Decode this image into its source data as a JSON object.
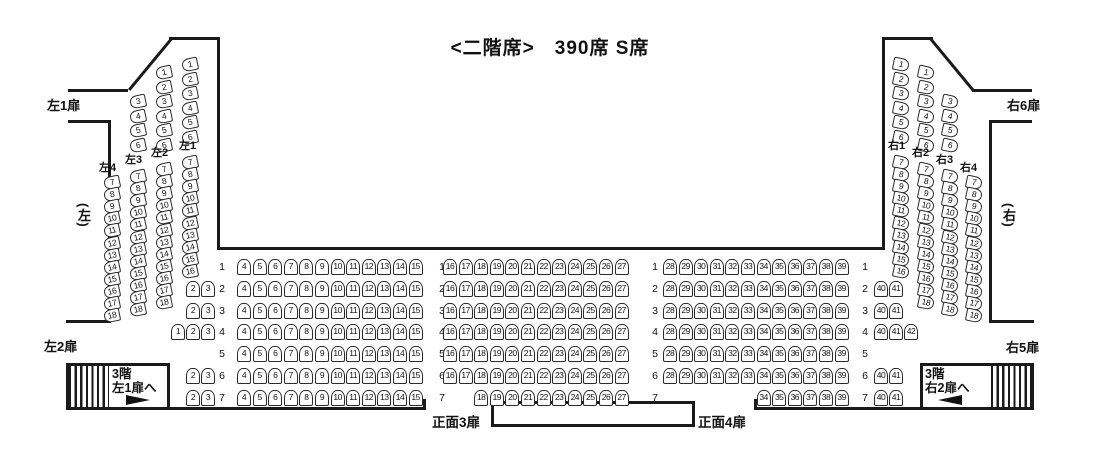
{
  "title": "<二階席>　390席 S席",
  "doors": {
    "left1": "左1扉",
    "left2": "左2扉",
    "right6": "右6扉",
    "right5": "右5扉",
    "front3": "正面3扉",
    "front4": "正面4扉"
  },
  "zones": {
    "left": "(左)",
    "right": "(右)"
  },
  "stairs": {
    "left": {
      "line1": "3階",
      "line2": "左1扉へ"
    },
    "right": {
      "line1": "3階",
      "line2": "右2扉へ"
    }
  },
  "colors": {
    "line": "#1a1a1a",
    "seat_border": "#2b2b2b",
    "background": "#ffffff"
  },
  "side_columns": {
    "left": [
      {
        "id": "L4",
        "label": "左4",
        "upper": [],
        "lower": [
          7,
          8,
          9,
          10,
          11,
          12,
          13,
          14,
          15,
          16,
          17,
          18
        ]
      },
      {
        "id": "L3",
        "label": "左3",
        "upper": [
          3,
          4,
          5,
          6
        ],
        "lower": [
          7,
          8,
          9,
          10,
          11,
          12,
          13,
          14,
          15,
          16,
          17,
          18
        ]
      },
      {
        "id": "L2",
        "label": "左2",
        "upper": [
          1,
          2,
          3,
          4,
          5,
          6
        ],
        "lower": [
          7,
          8,
          9,
          10,
          11,
          12,
          13,
          14,
          15,
          16,
          17,
          18
        ]
      },
      {
        "id": "L1",
        "label": "左1",
        "upper": [
          1,
          2,
          3,
          4,
          5,
          6
        ],
        "lower": [
          7,
          8,
          9,
          10,
          11,
          12,
          13,
          14,
          15,
          16
        ]
      }
    ],
    "right": [
      {
        "id": "R1",
        "label": "右1",
        "upper": [
          1,
          2,
          3,
          4,
          5,
          6
        ],
        "lower": [
          7,
          8,
          9,
          10,
          11,
          12,
          13,
          14,
          15,
          16
        ]
      },
      {
        "id": "R2",
        "label": "右2",
        "upper": [
          1,
          2,
          3,
          4,
          5,
          6
        ],
        "lower": [
          7,
          8,
          9,
          10,
          11,
          12,
          13,
          14,
          15,
          16,
          17,
          18
        ]
      },
      {
        "id": "R3",
        "label": "右3",
        "upper": [
          3,
          4,
          5,
          6
        ],
        "lower": [
          7,
          8,
          9,
          10,
          11,
          12,
          13,
          14,
          15,
          16,
          17,
          18
        ]
      },
      {
        "id": "R4",
        "label": "右4",
        "upper": [],
        "lower": [
          7,
          8,
          9,
          10,
          11,
          12,
          13,
          14,
          15,
          16,
          17,
          18
        ]
      }
    ]
  },
  "rows": [
    {
      "num": 1,
      "left_extra": [],
      "left": [
        4,
        5,
        6,
        7,
        8,
        9,
        10,
        11,
        12,
        13,
        14,
        15
      ],
      "center": [
        16,
        17,
        18,
        19,
        20,
        21,
        22,
        23,
        24,
        25,
        26,
        27
      ],
      "right": [
        28,
        29,
        30,
        31,
        32,
        33,
        34,
        35,
        36,
        37,
        38,
        39
      ],
      "right_extra": []
    },
    {
      "num": 2,
      "left_extra": [
        2,
        3
      ],
      "left": [
        4,
        5,
        6,
        7,
        8,
        9,
        10,
        11,
        12,
        13,
        14,
        15
      ],
      "center": [
        16,
        17,
        18,
        19,
        20,
        21,
        22,
        23,
        24,
        25,
        26,
        27
      ],
      "right": [
        28,
        29,
        30,
        31,
        32,
        33,
        34,
        35,
        36,
        37,
        38,
        39
      ],
      "right_extra": [
        40,
        41
      ]
    },
    {
      "num": 3,
      "left_extra": [
        2,
        3
      ],
      "left": [
        4,
        5,
        6,
        7,
        8,
        9,
        10,
        11,
        12,
        13,
        14,
        15
      ],
      "center": [
        16,
        17,
        18,
        19,
        20,
        21,
        22,
        23,
        24,
        25,
        26,
        27
      ],
      "right": [
        28,
        29,
        30,
        31,
        32,
        33,
        34,
        35,
        36,
        37,
        38,
        39
      ],
      "right_extra": [
        40,
        41
      ]
    },
    {
      "num": 4,
      "left_extra": [
        1,
        2,
        3
      ],
      "left": [
        4,
        5,
        6,
        7,
        8,
        9,
        10,
        11,
        12,
        13,
        14,
        15
      ],
      "center": [
        16,
        17,
        18,
        19,
        20,
        21,
        22,
        23,
        24,
        25,
        26,
        27
      ],
      "right": [
        28,
        29,
        30,
        31,
        32,
        33,
        34,
        35,
        36,
        37,
        38,
        39
      ],
      "right_extra": [
        40,
        41,
        42
      ]
    },
    {
      "num": 5,
      "left_extra": [],
      "left": [
        4,
        5,
        6,
        7,
        8,
        9,
        10,
        11,
        12,
        13,
        14,
        15
      ],
      "center": [
        16,
        17,
        18,
        19,
        20,
        21,
        22,
        23,
        24,
        25,
        26,
        27
      ],
      "right": [
        28,
        29,
        30,
        31,
        32,
        33,
        34,
        35,
        36,
        37,
        38,
        39
      ],
      "right_extra": []
    },
    {
      "num": 6,
      "left_extra": [
        2,
        3
      ],
      "left": [
        4,
        5,
        6,
        7,
        8,
        9,
        10,
        11,
        12,
        13,
        14,
        15
      ],
      "center": [
        16,
        17,
        18,
        19,
        20,
        21,
        22,
        23,
        24,
        25,
        26,
        27
      ],
      "right": [
        28,
        29,
        30,
        31,
        32,
        33,
        34,
        35,
        36,
        37,
        38,
        39
      ],
      "right_extra": [
        40,
        41
      ]
    },
    {
      "num": 7,
      "left_extra": [
        2,
        3
      ],
      "left": [
        4,
        5,
        6,
        7,
        8,
        9,
        10,
        11,
        12,
        13,
        14,
        15
      ],
      "center": [
        18,
        19,
        20,
        21,
        22,
        23,
        24,
        25,
        26,
        27
      ],
      "right": [
        34,
        35,
        36,
        37,
        38,
        39
      ],
      "right_extra": [
        40,
        41
      ]
    }
  ]
}
